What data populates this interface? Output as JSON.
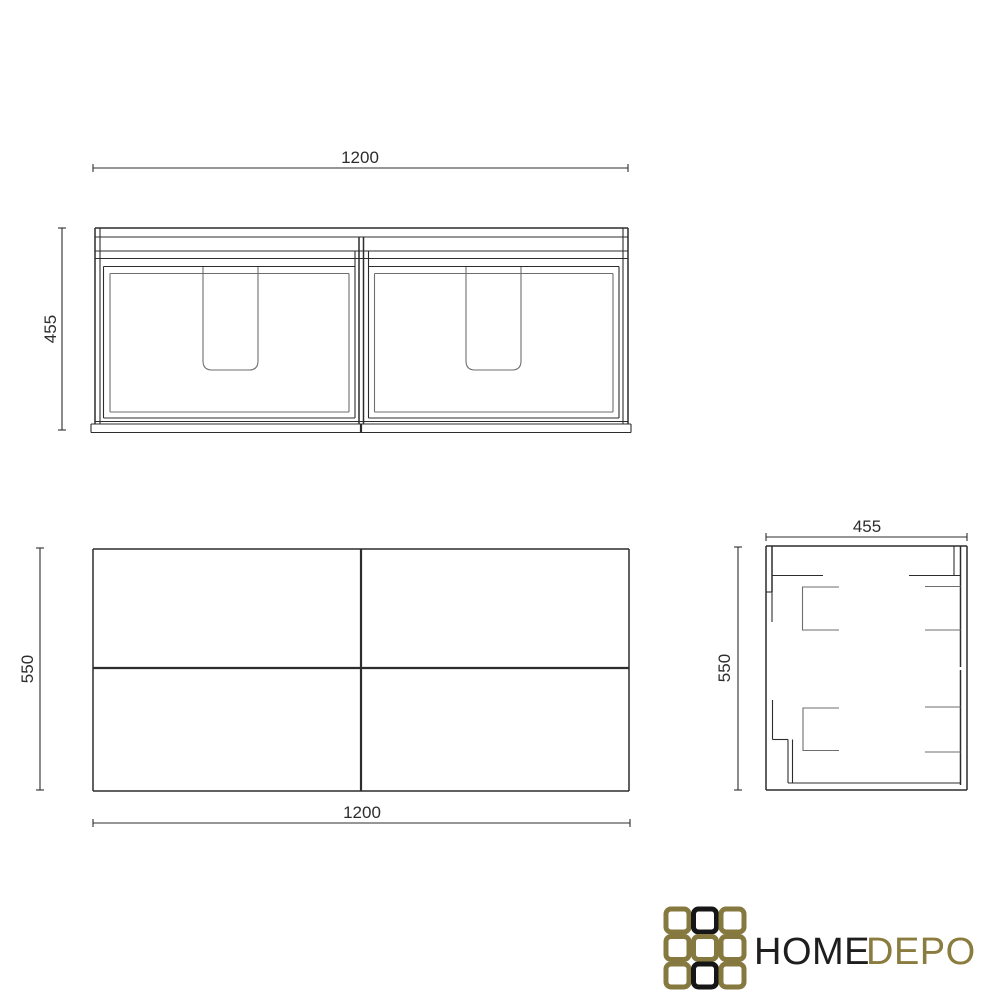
{
  "drawing": {
    "line_color": "#2d2d2d",
    "secondary_line_color": "#6e6e6e",
    "views": {
      "front": {
        "width_label": "1200",
        "height_label": "455"
      },
      "plan": {
        "width_label": "1200",
        "depth_label": "550"
      },
      "side": {
        "width_label": "455",
        "height_label": "550"
      }
    }
  },
  "logo": {
    "text_primary": "HOME",
    "text_secondary": "DEPO",
    "primary_color": "#1e1e1e",
    "secondary_color": "#8a7b3e",
    "grid_cells": [
      "#86793f",
      "#161616",
      "#86793f",
      "#86793f",
      "#86793f",
      "#86793f",
      "#86793f",
      "#161616",
      "#86793f"
    ]
  }
}
